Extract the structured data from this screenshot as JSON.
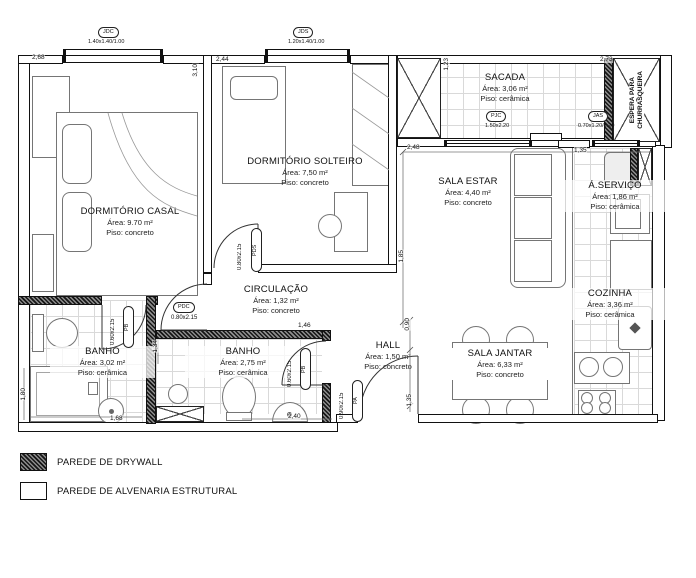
{
  "plan": {
    "rooms": [
      {
        "id": "dormitorio-casal",
        "name": "DORMITÓRIO CASAL",
        "area": "Área: 9.70 m²",
        "floor": "Piso: concreto"
      },
      {
        "id": "dormitorio-solteiro",
        "name": "DORMITÓRIO SOLTEIRO",
        "area": "Área: 7,50 m²",
        "floor": "Piso: concreto"
      },
      {
        "id": "sacada",
        "name": "SACADA",
        "area": "Área: 3,06 m²",
        "floor": "Piso: cerâmica"
      },
      {
        "id": "sala-estar",
        "name": "SALA ESTAR",
        "area": "Área: 4,40 m²",
        "floor": "Piso: concreto"
      },
      {
        "id": "area-servico",
        "name": "Á.SERVIÇO",
        "area": "Área: 1,86 m²",
        "floor": "Piso: cerâmica"
      },
      {
        "id": "cozinha",
        "name": "COZINHA",
        "area": "Área: 3,36 m²",
        "floor": "Piso: cerâmica"
      },
      {
        "id": "sala-jantar",
        "name": "SALA JANTAR",
        "area": "Área: 6,33 m²",
        "floor": "Piso: concreto"
      },
      {
        "id": "hall",
        "name": "HALL",
        "area": "Área: 1,50 m²",
        "floor": "Piso: concreto"
      },
      {
        "id": "circulacao",
        "name": "CIRCULAÇÃO",
        "area": "Área: 1,32 m²",
        "floor": "Piso: concreto"
      },
      {
        "id": "banho-1",
        "name": "BANHO",
        "area": "Área: 3,02 m²",
        "floor": "Piso: cerâmica"
      },
      {
        "id": "banho-2",
        "name": "BANHO",
        "area": "Área: 2,75 m²",
        "floor": "Piso: cerâmica"
      }
    ],
    "openings": {
      "jdc": {
        "tag": "JDC",
        "size": "1.40x1.40/1.00"
      },
      "jds": {
        "tag": "JDS",
        "size": "1.20x1.40/1.00"
      },
      "pjc": {
        "tag": "PJC",
        "size": "1.50x2.20"
      },
      "jas": {
        "tag": "JAS",
        "size": "0.70x1.20/1.20"
      },
      "pdc": {
        "tag": "PDC",
        "size": "0.80x2.15"
      },
      "pds": {
        "tag": "PDS",
        "size": "0.80x2.15"
      },
      "pb1": {
        "tag": "PB",
        "size": "0.60x2.15"
      },
      "pb2": {
        "tag": "PB",
        "size": "0.60x2.15"
      },
      "pa": {
        "tag": "PA",
        "size": "0.90x2.15"
      }
    },
    "dimensions": {
      "casal_width": "2,68",
      "casal_height": "3,10",
      "solteiro_width": "2,44",
      "estar_width": "2,48",
      "shaft_height": "1,23",
      "sacada_width": "2,73",
      "servico_width": "1,35",
      "estar_height": "1,85",
      "hall_top": "0,90",
      "hall_bottom": "1,35",
      "circulacao_width": "1,46",
      "banho1_height": "1,80",
      "banho1_width": "1,68",
      "banho2_width": "2,40",
      "banho1_side": "1,34"
    },
    "annotations": {
      "churrasqueira_line1": "ESPERA PARA",
      "churrasqueira_line2": "CHURRASQUEIRA"
    }
  },
  "legend": {
    "items": [
      {
        "label": "PAREDE DE DRYWALL"
      },
      {
        "label": "PAREDE DE ALVENARIA ESTRUTURAL"
      }
    ]
  }
}
